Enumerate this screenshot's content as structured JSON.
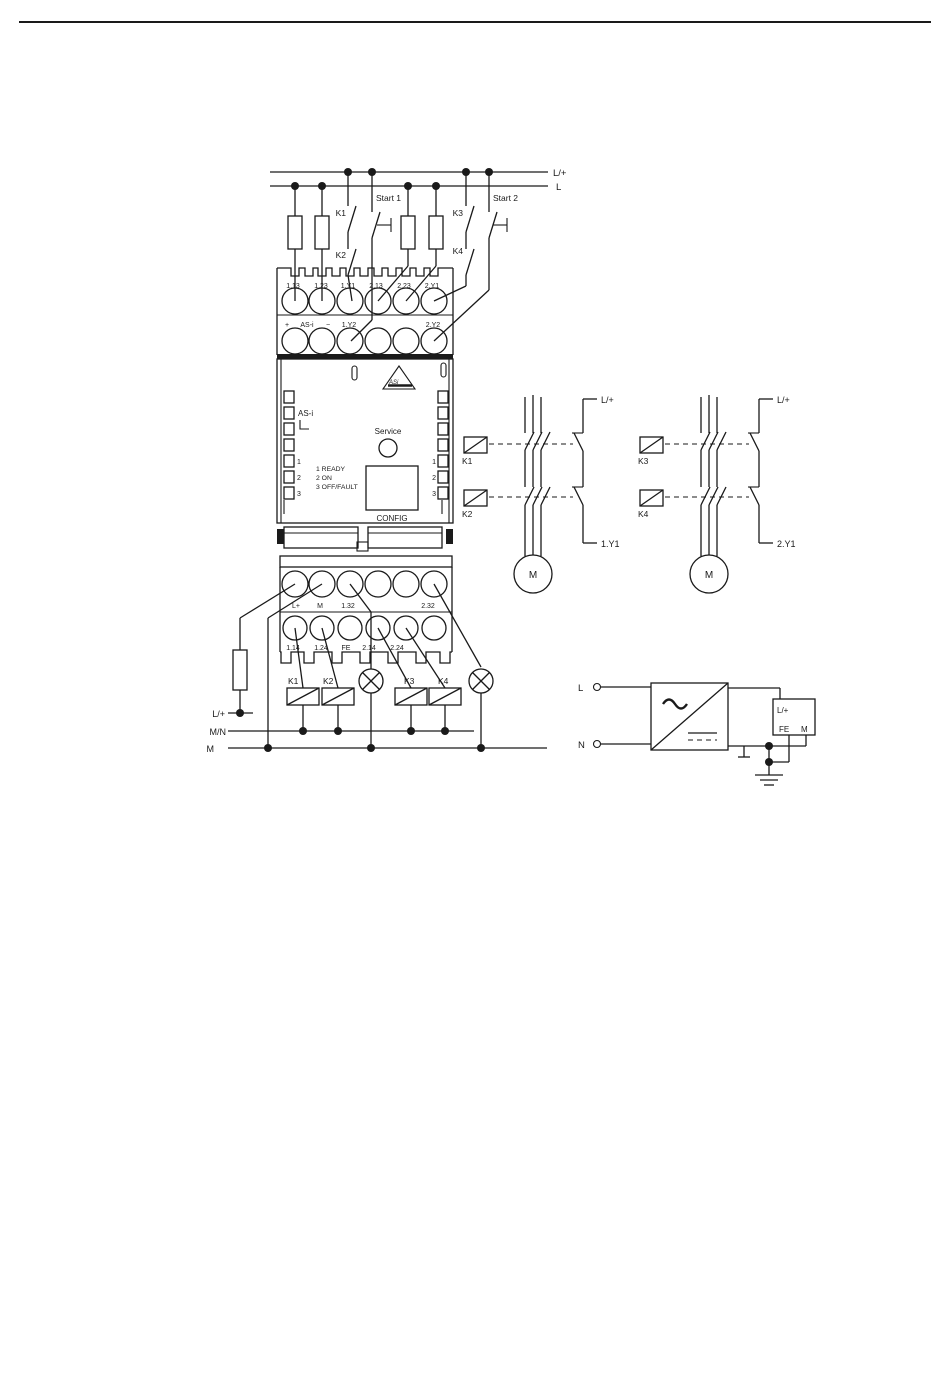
{
  "rails": {
    "lplus": "L/+",
    "l": "L"
  },
  "control_contacts": {
    "k1": "K1",
    "k2": "K2",
    "start1": "Start 1",
    "k3": "K3",
    "k4": "K4",
    "start2": "Start 2"
  },
  "top_block": {
    "row1": [
      "1.13",
      "1.23",
      "1.Y1",
      "2.13",
      "2.23",
      "2.Y1"
    ],
    "plus": "+",
    "asi": "AS-i",
    "minus": "−",
    "y2_left": "1.Y2",
    "y2_right": "2.Y2"
  },
  "module": {
    "asi": "AS-i",
    "logo": "ASi",
    "service": "Service",
    "legend": [
      "1 READY",
      "2 ON",
      "3 OFF/FAULT"
    ],
    "left_leds": [
      "1",
      "2",
      "3"
    ],
    "right_leds": [
      "1",
      "2",
      "3"
    ],
    "config": "CONFIG"
  },
  "bottom_block": {
    "row1": [
      "L+",
      "M",
      "1.32",
      "2.32"
    ],
    "row2": [
      "1.14",
      "1.24",
      "FE",
      "2.14",
      "2.24"
    ]
  },
  "outputs": {
    "k1": "K1",
    "k2": "K2",
    "k3": "K3",
    "k4": "K4",
    "lplus": "L/+",
    "mn": "M/N",
    "m": "M"
  },
  "motor_circuit_1": {
    "coil_top": "K1",
    "coil_bottom": "K2",
    "motor": "M",
    "supply": "L/+",
    "control": "1.Y1"
  },
  "motor_circuit_2": {
    "coil_top": "K3",
    "coil_bottom": "K4",
    "motor": "M",
    "supply": "L/+",
    "control": "2.Y1"
  },
  "power_supply": {
    "l": "L",
    "n": "N",
    "lplus": "L/+",
    "fe": "FE",
    "m": "M"
  }
}
